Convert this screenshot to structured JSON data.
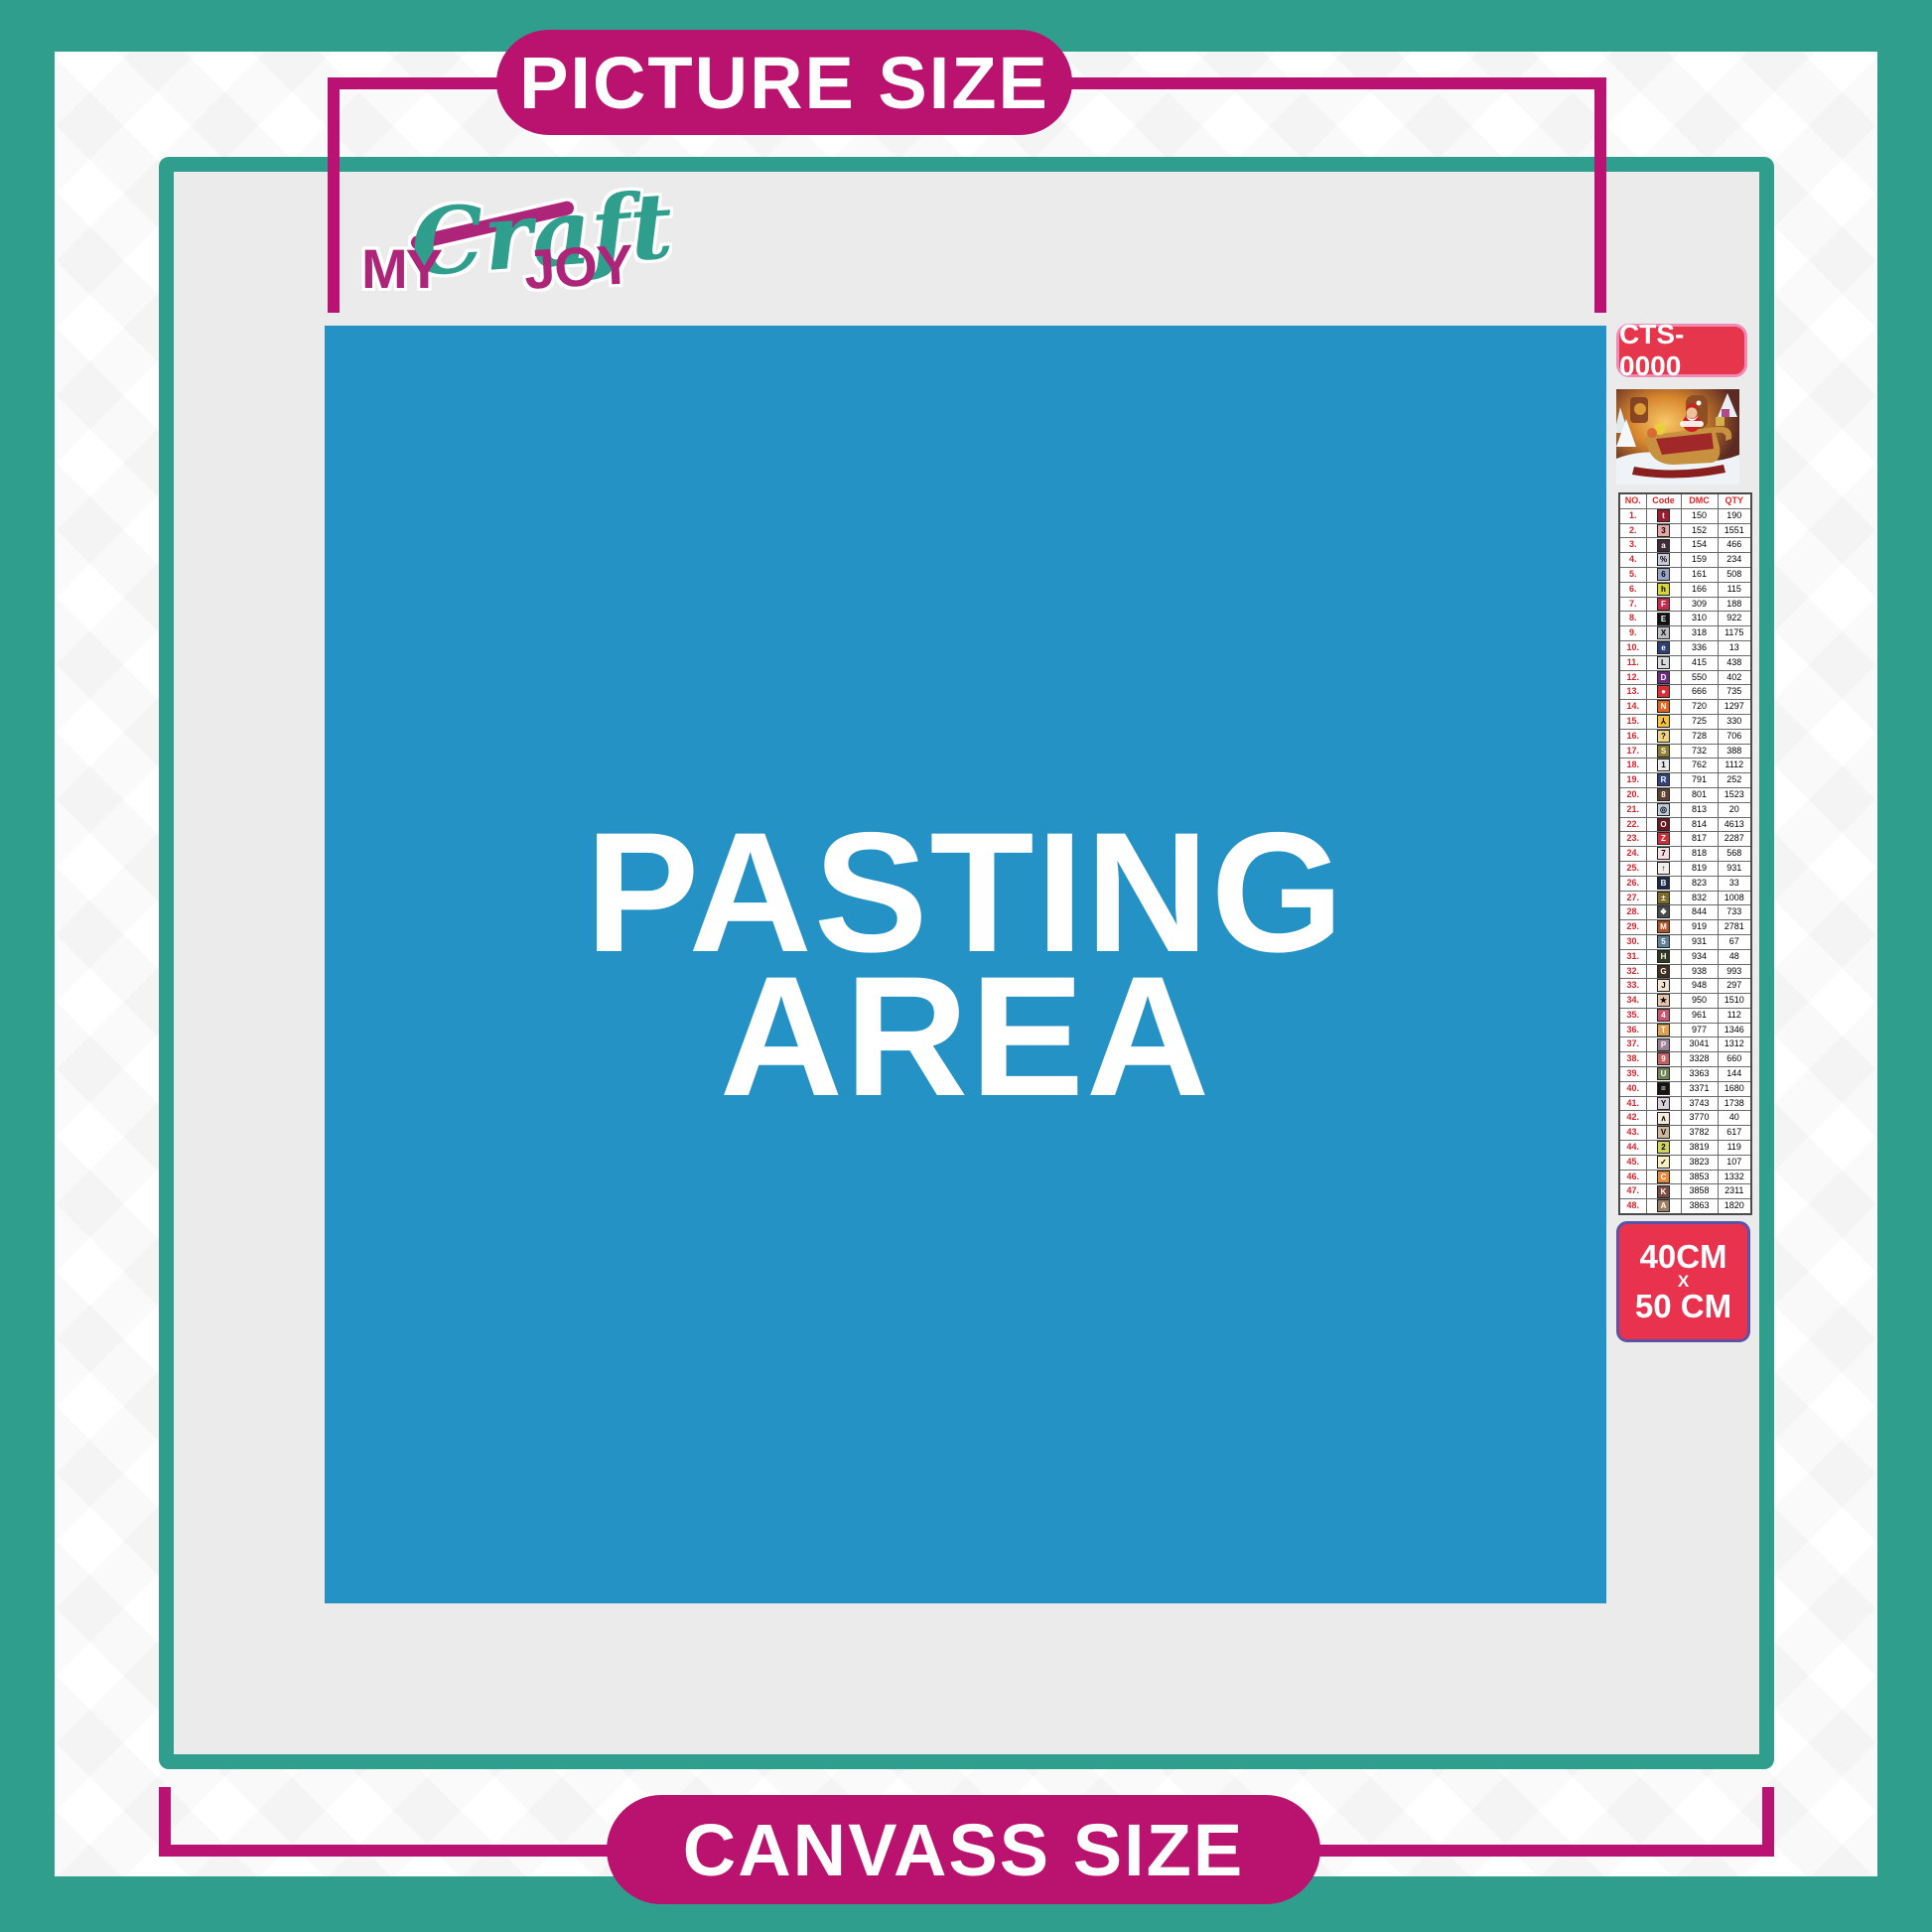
{
  "banners": {
    "top": "PICTURE SIZE",
    "bottom": "CANVASS SIZE"
  },
  "logo": {
    "word1": "MY",
    "word2": "Craft",
    "word3": "JOY"
  },
  "pasting_area": {
    "line1": "PASTING",
    "line2": "AREA"
  },
  "product": {
    "sku": "CTS-0000",
    "size": {
      "line1": "40CM",
      "line2": "X",
      "line3": "50 CM"
    }
  },
  "colors": {
    "teal": "#2f9e8d",
    "magenta_frame": "#ba1273",
    "pill_magenta": "#b9136f",
    "pasting_blue": "#2492c4",
    "badge_red": "#e5364b",
    "sku_border_pink": "#ef8ab5",
    "size_border_purple": "#5c53a5",
    "interior_gray": "#ebebeb"
  },
  "legend": {
    "headers": [
      "NO.",
      "Code",
      "DMC",
      "QTY"
    ],
    "rows": [
      [
        "1.",
        "t",
        "#9b1b30",
        "#ffffff",
        "150",
        "190"
      ],
      [
        "2.",
        "3",
        "#e8a5a2",
        "#000000",
        "152",
        "1551"
      ],
      [
        "3.",
        "a",
        "#3f2a3a",
        "#ffffff",
        "154",
        "466"
      ],
      [
        "4.",
        "%",
        "#c5c9d6",
        "#000000",
        "159",
        "234"
      ],
      [
        "5.",
        "6",
        "#9aa3c4",
        "#000000",
        "161",
        "508"
      ],
      [
        "6.",
        "h",
        "#d5d53a",
        "#000000",
        "166",
        "115"
      ],
      [
        "7.",
        "F",
        "#c22c4e",
        "#ffffff",
        "309",
        "188"
      ],
      [
        "8.",
        "E",
        "#111111",
        "#ffffff",
        "310",
        "922"
      ],
      [
        "9.",
        "X",
        "#b9bcc3",
        "#000000",
        "318",
        "1175"
      ],
      [
        "10.",
        "e",
        "#2b4075",
        "#ffffff",
        "336",
        "13"
      ],
      [
        "11.",
        "L",
        "#d8dade",
        "#000000",
        "415",
        "438"
      ],
      [
        "12.",
        "D",
        "#6b2d7d",
        "#ffffff",
        "550",
        "402"
      ],
      [
        "13.",
        "●",
        "#df2b35",
        "#ffffff",
        "666",
        "735"
      ],
      [
        "14.",
        "N",
        "#e2641f",
        "#ffffff",
        "720",
        "1297"
      ],
      [
        "15.",
        "⅄",
        "#f4c33b",
        "#000000",
        "725",
        "330"
      ],
      [
        "16.",
        "?",
        "#f0d287",
        "#000000",
        "728",
        "706"
      ],
      [
        "17.",
        "S",
        "#8d7d2e",
        "#ffffff",
        "732",
        "388"
      ],
      [
        "18.",
        "1",
        "#e9e9ea",
        "#000000",
        "762",
        "1112"
      ],
      [
        "19.",
        "R",
        "#33427f",
        "#ffffff",
        "791",
        "252"
      ],
      [
        "20.",
        "8",
        "#5e4130",
        "#ffffff",
        "801",
        "1523"
      ],
      [
        "21.",
        "◎",
        "#bccadb",
        "#000000",
        "813",
        "20"
      ],
      [
        "22.",
        "O",
        "#6d1820",
        "#ffffff",
        "814",
        "4613"
      ],
      [
        "23.",
        "Z",
        "#c9303c",
        "#ffffff",
        "817",
        "2287"
      ],
      [
        "24.",
        "7",
        "#f6dde2",
        "#000000",
        "818",
        "568"
      ],
      [
        "25.",
        "↑",
        "#f3eeea",
        "#000000",
        "819",
        "931"
      ],
      [
        "26.",
        "B",
        "#1c2a4a",
        "#ffffff",
        "823",
        "33"
      ],
      [
        "27.",
        "±",
        "#7c6b2a",
        "#ffffff",
        "832",
        "1008"
      ],
      [
        "28.",
        "❖",
        "#4a4a48",
        "#ffffff",
        "844",
        "733"
      ],
      [
        "29.",
        "M",
        "#b05426",
        "#ffffff",
        "919",
        "2781"
      ],
      [
        "30.",
        "5",
        "#5f7f99",
        "#ffffff",
        "931",
        "67"
      ],
      [
        "31.",
        "H",
        "#2f3b20",
        "#ffffff",
        "934",
        "48"
      ],
      [
        "32.",
        "G",
        "#42301f",
        "#ffffff",
        "938",
        "993"
      ],
      [
        "33.",
        "J",
        "#f3e3d0",
        "#000000",
        "948",
        "297"
      ],
      [
        "34.",
        "★",
        "#e8c3a8",
        "#000000",
        "950",
        "1510"
      ],
      [
        "35.",
        "4",
        "#c8566f",
        "#ffffff",
        "961",
        "112"
      ],
      [
        "36.",
        "T",
        "#dc9f4e",
        "#ffffff",
        "977",
        "1346"
      ],
      [
        "37.",
        "P",
        "#9c7f92",
        "#ffffff",
        "3041",
        "1312"
      ],
      [
        "38.",
        "9",
        "#c55f63",
        "#ffffff",
        "3328",
        "660"
      ],
      [
        "39.",
        "U",
        "#6f8355",
        "#ffffff",
        "3363",
        "144"
      ],
      [
        "40.",
        "=",
        "#171310",
        "#ffffff",
        "3371",
        "1680"
      ],
      [
        "41.",
        "Y",
        "#d9d0da",
        "#000000",
        "3743",
        "1738"
      ],
      [
        "42.",
        "∧",
        "#f6eadd",
        "#000000",
        "3770",
        "40"
      ],
      [
        "43.",
        "V",
        "#cdb89e",
        "#000000",
        "3782",
        "617"
      ],
      [
        "44.",
        "2",
        "#cfd45e",
        "#000000",
        "3819",
        "119"
      ],
      [
        "45.",
        "✓",
        "#f7efc0",
        "#000000",
        "3823",
        "107"
      ],
      [
        "46.",
        "C",
        "#e88a3a",
        "#ffffff",
        "3853",
        "1332"
      ],
      [
        "47.",
        "K",
        "#7c4a42",
        "#ffffff",
        "3858",
        "2311"
      ],
      [
        "48.",
        "A",
        "#9c7f63",
        "#ffffff",
        "3863",
        "1820"
      ]
    ]
  }
}
